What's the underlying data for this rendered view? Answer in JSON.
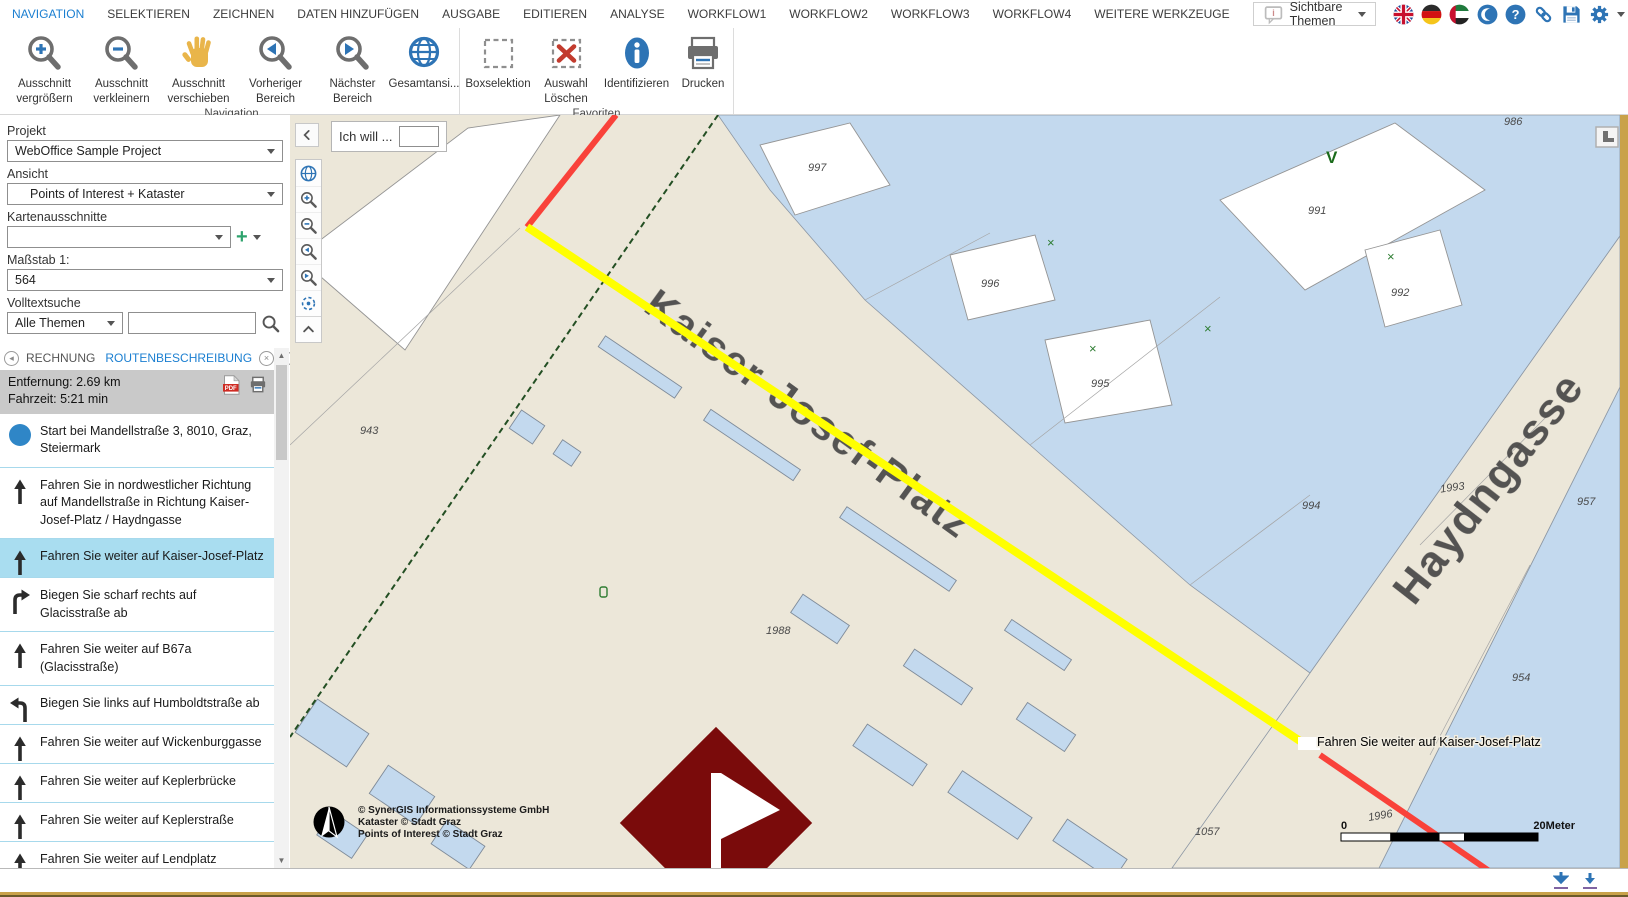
{
  "menubar": {
    "items": [
      {
        "label": "NAVIGATION",
        "active": true
      },
      {
        "label": "SELEKTIEREN"
      },
      {
        "label": "ZEICHNEN"
      },
      {
        "label": "DATEN HINZUFÜGEN"
      },
      {
        "label": "AUSGABE"
      },
      {
        "label": "EDITIEREN"
      },
      {
        "label": "ANALYSE"
      },
      {
        "label": "WORKFLOW1"
      },
      {
        "label": "WORKFLOW2"
      },
      {
        "label": "WORKFLOW3"
      },
      {
        "label": "WORKFLOW4"
      },
      {
        "label": "WEITERE WERKZEUGE"
      }
    ],
    "themes_dropdown_label": "Sichtbare Themen"
  },
  "ribbon": {
    "groups": [
      {
        "label": "Navigation",
        "buttons": [
          {
            "label": "Ausschnitt vergrößern",
            "icon": "zoom-in"
          },
          {
            "label": "Ausschnitt verkleinern",
            "icon": "zoom-out"
          },
          {
            "label": "Ausschnitt verschieben",
            "icon": "pan-hand"
          },
          {
            "label": "Vorheriger Bereich",
            "icon": "previous-extent"
          },
          {
            "label": "Nächster Bereich",
            "icon": "next-extent"
          },
          {
            "label": "Gesamtansi...",
            "icon": "full-extent-globe"
          }
        ]
      },
      {
        "label": "Favoriten",
        "buttons": [
          {
            "label": "Boxselektion",
            "icon": "box-selection"
          },
          {
            "label": "Auswahl Löschen",
            "icon": "clear-selection"
          },
          {
            "label": "Identifizieren",
            "icon": "identify"
          },
          {
            "label": "Drucken",
            "icon": "print"
          }
        ]
      }
    ]
  },
  "sidebar": {
    "project_label": "Projekt",
    "project_value": "WebOffice Sample Project",
    "view_label": "Ansicht",
    "view_value": "Points of Interest + Kataster",
    "extents_label": "Kartenausschnitte",
    "extents_value": "",
    "scale_label": "Maßstab 1:",
    "scale_value": "564",
    "fulltext_label": "Volltextsuche",
    "fulltext_scope": "Alle Themen",
    "fulltext_query": "",
    "tabs": {
      "left_tab": "RECHNUNG",
      "active_tab": "ROUTENBESCHREIBUNG"
    },
    "route_summary": {
      "distance": "Entfernung: 2.69 km",
      "duration": "Fahrzeit: 5:21 min"
    },
    "steps": [
      {
        "maneuver": "start",
        "text": "Start bei Mandellstraße 3, 8010, Graz, Steiermark"
      },
      {
        "maneuver": "straight",
        "text": "Fahren Sie in nordwestlicher Richtung auf Mandellstraße in Richtung Kaiser-Josef-Platz / Haydngasse"
      },
      {
        "maneuver": "straight",
        "selected": true,
        "text": "Fahren Sie weiter auf Kaiser-Josef-Platz"
      },
      {
        "maneuver": "sharp-right",
        "text": "Biegen Sie scharf rechts auf Glacisstraße ab"
      },
      {
        "maneuver": "straight",
        "text": "Fahren Sie weiter auf B67a (Glacisstraße)"
      },
      {
        "maneuver": "left",
        "text": "Biegen Sie links auf Humboldtstraße ab"
      },
      {
        "maneuver": "straight",
        "text": "Fahren Sie weiter auf Wickenburggasse"
      },
      {
        "maneuver": "straight",
        "text": "Fahren Sie weiter auf Keplerbrücke"
      },
      {
        "maneuver": "straight",
        "text": "Fahren Sie weiter auf Keplerstraße"
      },
      {
        "maneuver": "straight",
        "text": "Fahren Sie weiter auf Lendplatz"
      }
    ]
  },
  "map": {
    "ich_will_label": "Ich will ...",
    "street_label_1": "Kaiser-Josef-Platz",
    "street_label_2": "Haydngasse",
    "route_tooltip": "Fahren Sie weiter auf Kaiser-Josef-Platz",
    "green_marker": "V",
    "parcels": [
      "986",
      "997",
      "991",
      "996",
      "992",
      "995",
      "943",
      "1993",
      "994",
      "957",
      "1988",
      "954",
      "1996",
      "1057"
    ],
    "copyright_1": "© SynerGIS Informationssysteme GmbH",
    "copyright_2": "Kataster © Stadt Graz",
    "copyright_3": "Points of Interest © Stadt Graz",
    "scalebar": {
      "start": "0",
      "end": "20Meter"
    }
  },
  "colors": {
    "accent_blue": "#2e74b5",
    "active_menu_blue": "#1b7fd1",
    "highlight_row": "#a9ddf0",
    "route_yellow": "#ffff00",
    "route_red": "#f9423a",
    "flag_maroon": "#7a0b0b",
    "map_beige": "#ece7d9",
    "map_blue": "#c3d9ee",
    "frame_gold": "#c9a24a"
  }
}
